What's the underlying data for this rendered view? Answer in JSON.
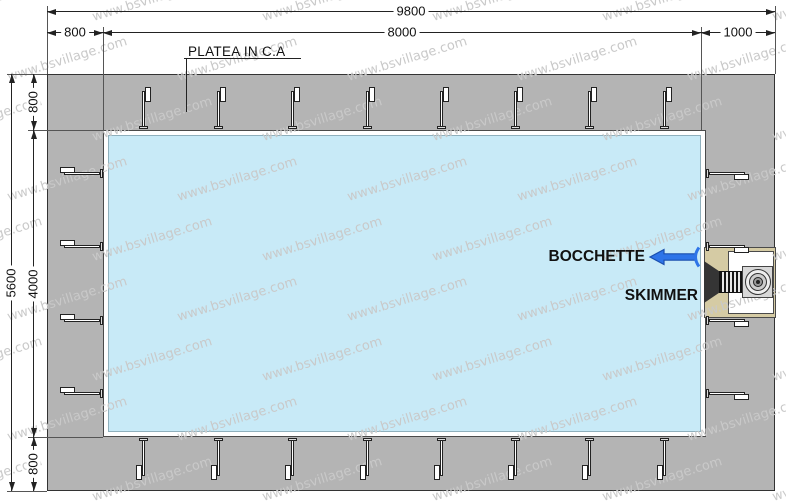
{
  "watermark": {
    "text": "www.bsvillage.com"
  },
  "labels": {
    "platea": "PLATEA IN C.A",
    "bocchette": "BOCCHETTE",
    "skimmer": "SKIMMER"
  },
  "dimensions": {
    "total_width": "9800",
    "left_offset": "800",
    "pool_length": "8000",
    "right_offset": "1000",
    "total_height": "5600",
    "top_offset": "800",
    "pool_width": "4000",
    "bottom_offset": "800"
  },
  "colors": {
    "platea": "#b4b4b4",
    "water": "#c8eaf7",
    "skimmer_housing": "#d5cba4",
    "arrow_blue": "#2e74e8",
    "watermark": "#c9c9c9"
  }
}
